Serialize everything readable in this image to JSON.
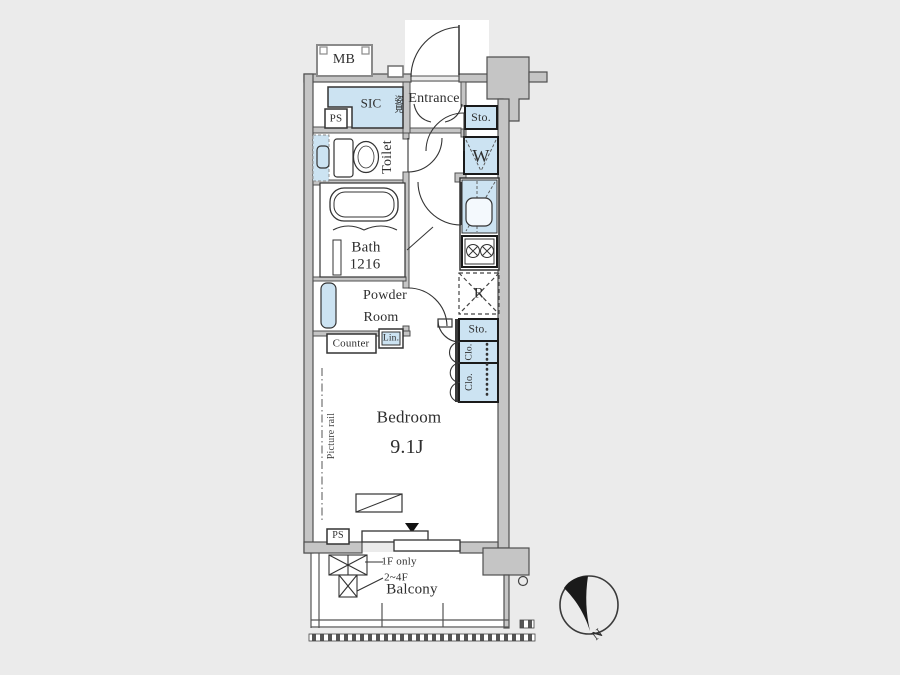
{
  "plan": {
    "unit": {
      "meter_box": "MB",
      "pipe_space_top": "PS",
      "shoe_closet": "SIC",
      "mirror": "姿見",
      "entrance": "Entrance",
      "entry_storage": "Sto.",
      "washer_space": "W",
      "toilet": "Toilet",
      "bath": "Bath",
      "bath_size": "1216",
      "powder_line1": "Powder",
      "powder_line2": "Room",
      "counter": "Counter",
      "linen": "Lin.",
      "refrigerator_space": "R",
      "closet_storage": "Sto.",
      "closet_upper": "Clo.",
      "closet_lower": "Clo.",
      "bedroom": "Bedroom",
      "bedroom_size": "9.1J",
      "picture_rail": "Picture rail",
      "pipe_space_bottom": "PS"
    },
    "balcony": {
      "label": "Balcony",
      "hatch_note_1f": "1F only",
      "hatch_note_2_4f": "2~4F"
    },
    "compass": {
      "north": "N"
    },
    "colors": {
      "highlight_blue": "#cce3f2",
      "wall_gray": "#c5c5c5",
      "canvas_bg": "#ebebeb",
      "line": "#3d3d3d"
    }
  }
}
